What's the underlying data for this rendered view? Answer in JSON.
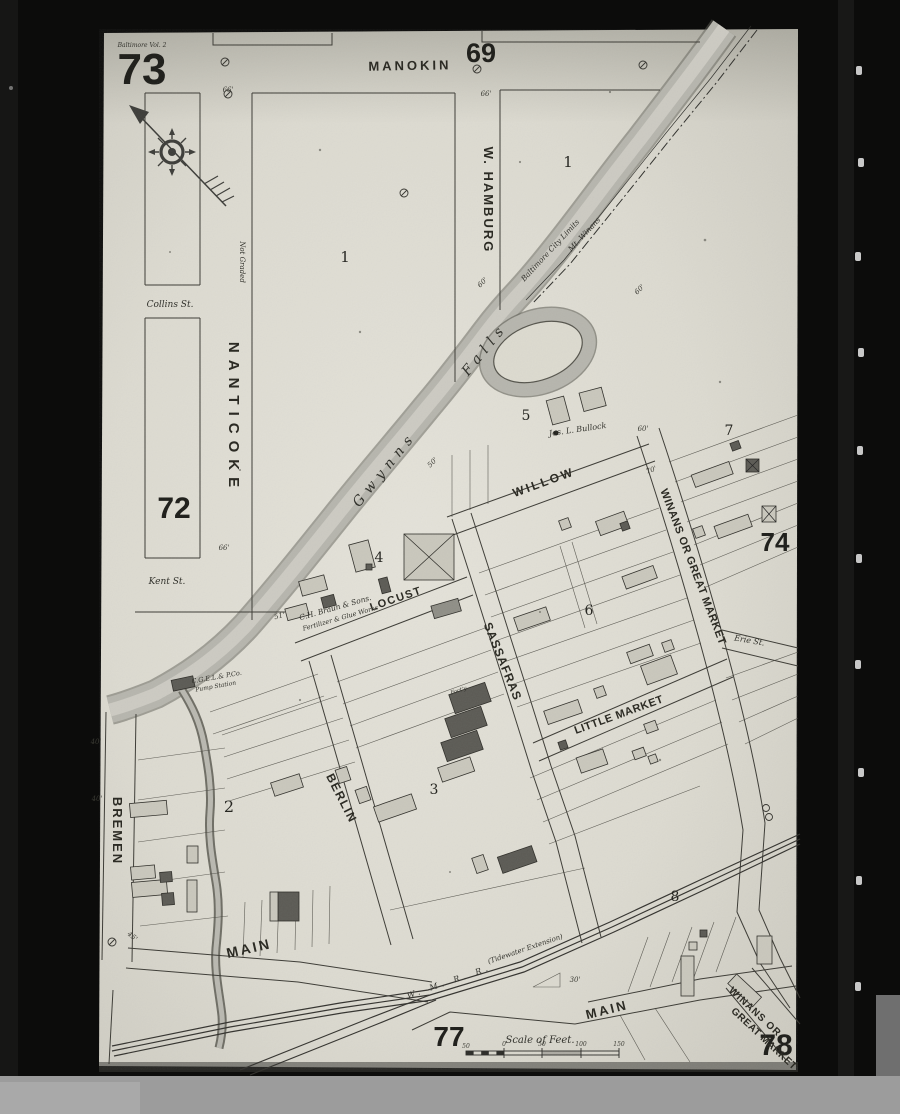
{
  "sheet": {
    "number": "73",
    "volume_note": "Baltimore Vol. 2"
  },
  "adjacent_sheets": {
    "north": "69",
    "west": "72",
    "east": "74",
    "southwest": "77",
    "southeast": "78"
  },
  "block_numbers": {
    "b1_west": "1",
    "b1_east": "1",
    "b2": "2",
    "b3": "3",
    "b4": "4",
    "b5": "5",
    "b6": "6",
    "b7": "7",
    "b8": "8"
  },
  "streets": {
    "manokin": "MANOKIN",
    "w_hamburg": "W. HAMBURG",
    "nanticoke": "NANTICOKE",
    "not_graded": "Not Graded",
    "collins": "Collins St.",
    "kent": "Kent St.",
    "willow": "WILLOW",
    "locust": "LOCUST",
    "sassafras": "SASSAFRAS",
    "little_market": "LITTLE MARKET",
    "winans_upper": "WINANS OR GREAT MARKET",
    "erie": "Erie St.",
    "bremen": "BREMEN",
    "berlin": "BERLIN",
    "main_west": "MAIN",
    "main_east": "MAIN",
    "winans_lower_1": "WINANS OR",
    "winans_lower_2": "GREAT MARKET"
  },
  "water": {
    "gwynns": "Gwynns",
    "falls": "Falls"
  },
  "railroads": {
    "city_limits": "Baltimore City Limits",
    "mt_winans": "Mt. Winans",
    "wmrr": "W. M. R. R.",
    "wmrr_ext": "(Tidewater Extension)"
  },
  "labels": {
    "bullock": "Jos. L. Bullock",
    "braun_1": "C.H. Braun & Sons.",
    "braun_2": "Fertilizer & Glue Works",
    "pump_1": "C.G.E.L.& P.Co.",
    "pump_2": "Pump Station",
    "factory": "Fact'y"
  },
  "scale_bar": {
    "title": "Scale of Feet.",
    "ticks": [
      "50",
      "0",
      "50",
      "100",
      "150"
    ]
  },
  "dimensions": [
    "66'",
    "66'",
    "66'",
    "60'",
    "60'",
    "60'",
    "70'",
    "50'",
    "51'",
    "30'",
    "40'",
    "40'",
    "45'"
  ]
}
